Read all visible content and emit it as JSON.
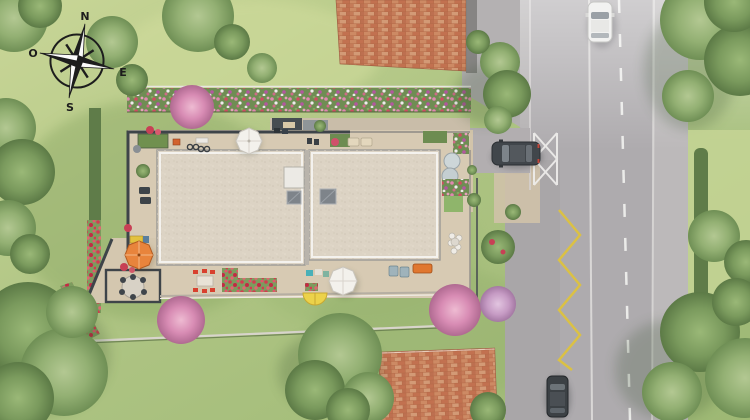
{
  "compass": {
    "north": "N",
    "west": "O",
    "east": "E",
    "south": "S"
  },
  "palette": {
    "lawn": "#a8bf7d",
    "lawn_light": "#ccd89b",
    "tree_green": "#7e9c62",
    "hedge_dark": "#5f7c49",
    "road": "#aeabae",
    "sidewalk": "#bcb9ba",
    "road_marking_white": "#f2f2f0",
    "road_marking_yellow": "#ddc23e",
    "main_roof": "#dcd3c4",
    "terrace": "#d7cab3",
    "wall_dark": "#3e4449",
    "brick_roof": "#c07a56",
    "flower_pink": "#e087b0",
    "flower_red": "#d04c63",
    "umbrella_orange": "#e8843c",
    "umbrella_yellow": "#ecd24a",
    "umbrella_white": "#f3f1ec",
    "car_dark": "#41464b",
    "car_white": "#f2f2f1"
  },
  "scene": {
    "objects": [
      "compass rose (N / O / E / S)",
      "main residential building with two beige flat-roof wings and rooftop skylights",
      "perimeter terraces with garden furniture",
      "white parasol north terrace",
      "orange parasol west terrace",
      "white parasol south terrace",
      "yellow parasol south terrace",
      "dining set with red chairs",
      "round garden table with chairs",
      "north flower hedge",
      "west hedge with red flowers",
      "neighbouring brick-tile roof north",
      "neighbouring brick-tile roof south",
      "street with dashed centre line",
      "white car driving on street",
      "dark car parked on driveway",
      "dark car parked along street",
      "white crosshatch driveway marking",
      "yellow zigzag kerb marking",
      "lawns, trees and flowering shrubs"
    ]
  }
}
